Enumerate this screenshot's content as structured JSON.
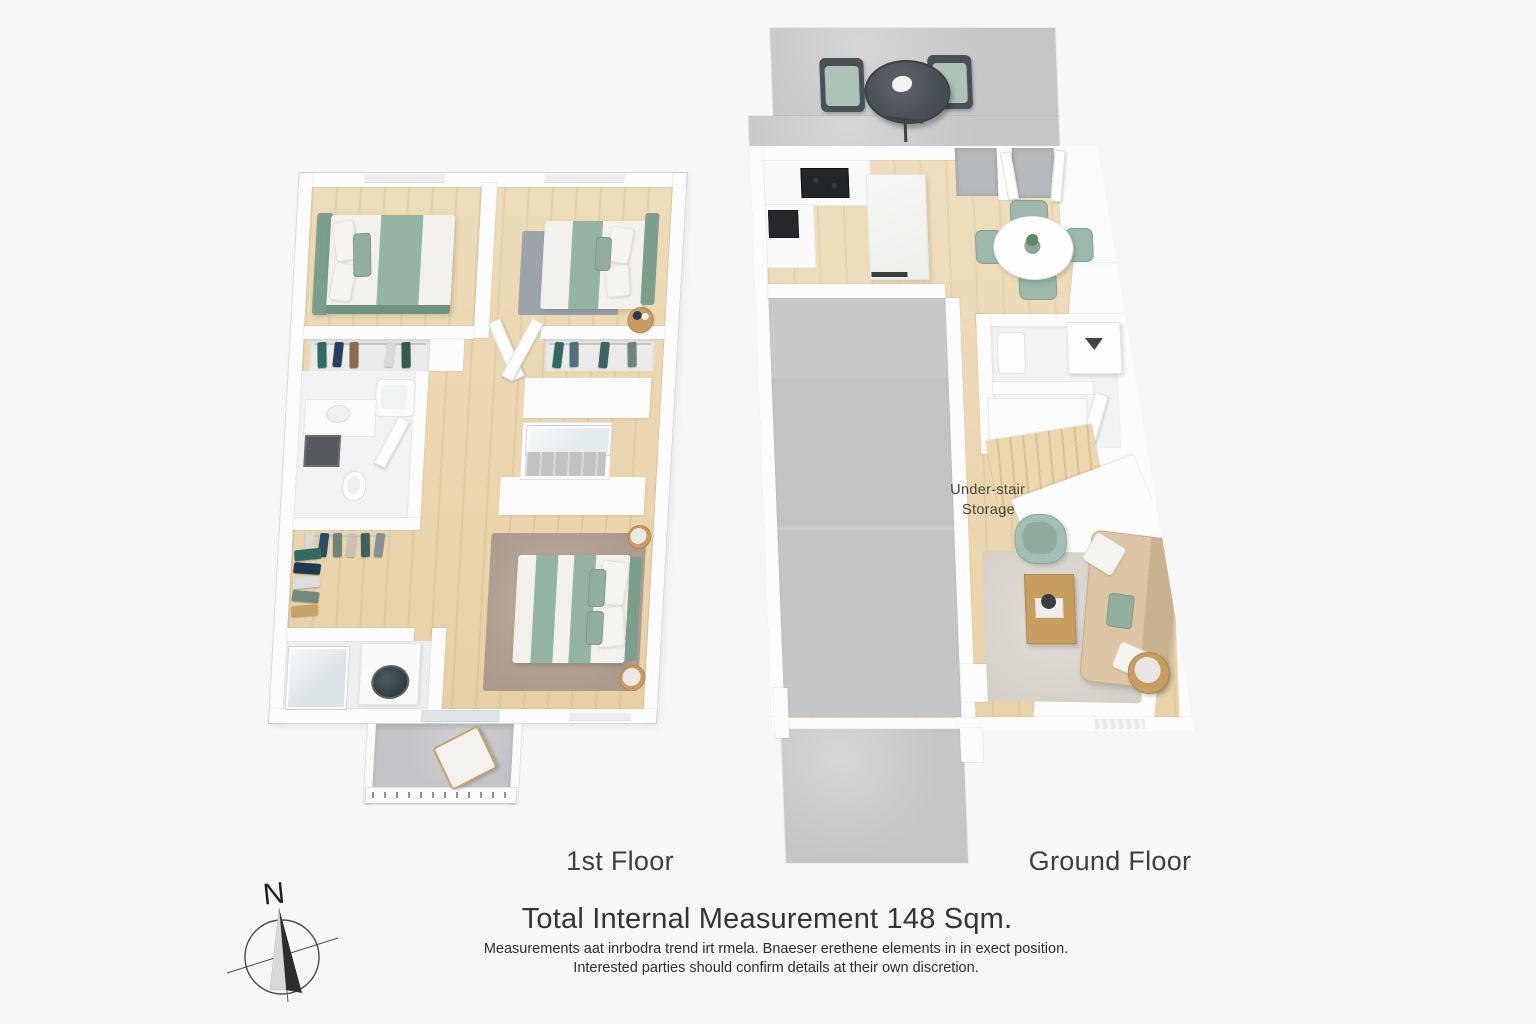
{
  "labels": {
    "first_floor": "1st Floor",
    "ground_floor": "Ground Floor"
  },
  "annotations": {
    "under_stair_line1": "Under-stair",
    "under_stair_line2": "Storage"
  },
  "compass": {
    "north_label": "N"
  },
  "footer": {
    "title": "Total Internal Measurement 148 Sqm.",
    "disclaimer_line1": "Measurements aat inrbodra trend irt rmela. Bnaeser erethene elements in in exect position.",
    "disclaimer_line2": "Interested parties should confirm details at their own discretion."
  },
  "palette": {
    "background": "#f7f7f7",
    "wall_white": "#fcfcfc",
    "wood_floor": "#e9d3aa",
    "concrete_gray": "#c5c6c8",
    "sage_green": "#94b3a2",
    "headboard_green": "#7b9e8d",
    "sofa_beige": "#d6bf9e",
    "rug_taupe": "#b4a395",
    "rug_gray": "#9da5ab",
    "furniture_wood": "#c89d60",
    "text_dark": "#3e3e3e"
  }
}
